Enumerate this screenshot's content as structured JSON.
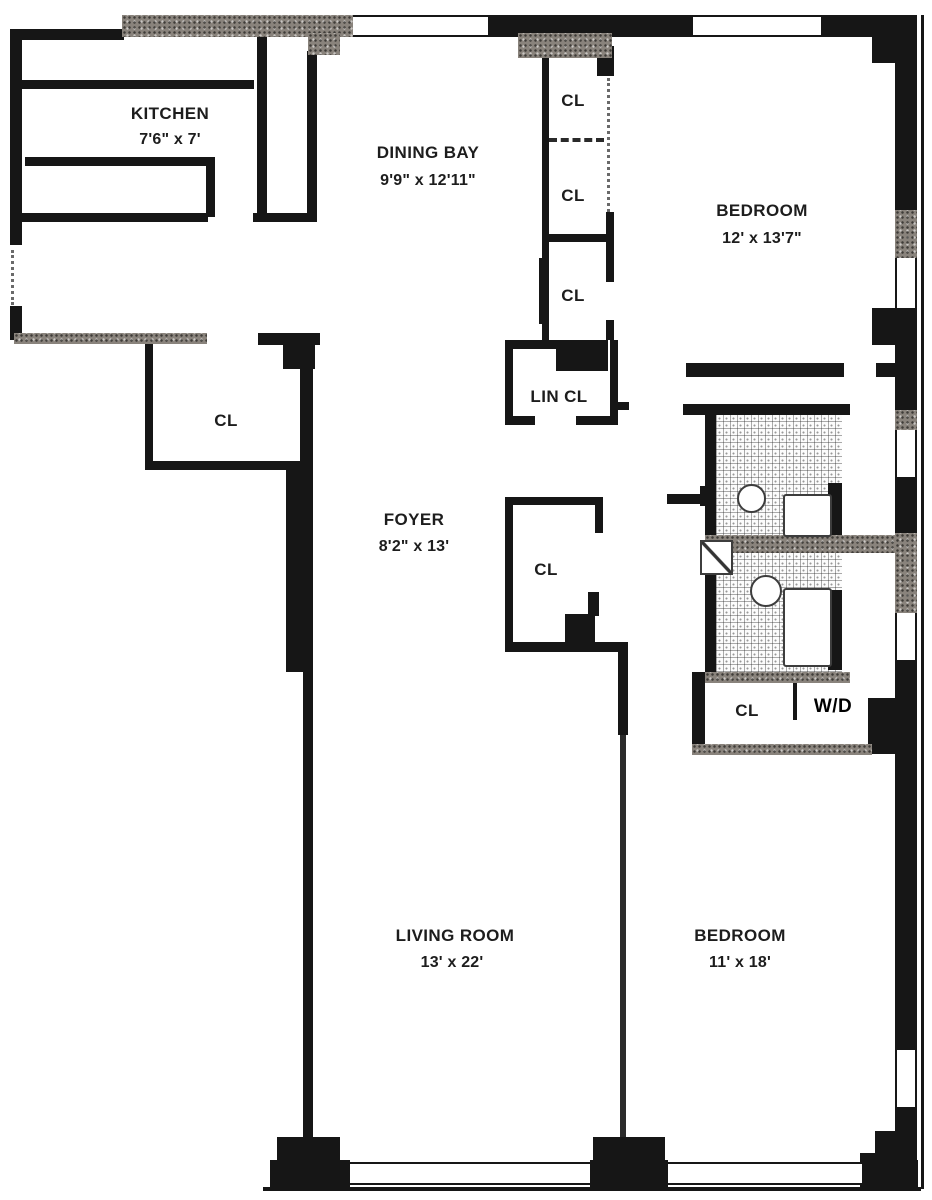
{
  "rooms": [
    {
      "id": "kitchen",
      "name": "KITCHEN",
      "dims": "7'6\" x 7'"
    },
    {
      "id": "dining-bay",
      "name": "DINING BAY",
      "dims": "9'9\" x 12'11\""
    },
    {
      "id": "bedroom-top",
      "name": "BEDROOM",
      "dims": "12' x 13'7\""
    },
    {
      "id": "foyer",
      "name": "FOYER",
      "dims": "8'2\" x 13'"
    },
    {
      "id": "living-room",
      "name": "LIVING ROOM",
      "dims": "13' x 22'"
    },
    {
      "id": "bedroom-bottom",
      "name": "BEDROOM",
      "dims": "11' x 18'"
    }
  ],
  "closet_labels": {
    "closet": "CL",
    "linen_closet": "LIN CL",
    "washer_dryer": "W/D"
  },
  "colors": {
    "wall": "#161616",
    "wall_textured": "#89837c",
    "background": "#ffffff",
    "text": "#1d1d1d"
  }
}
